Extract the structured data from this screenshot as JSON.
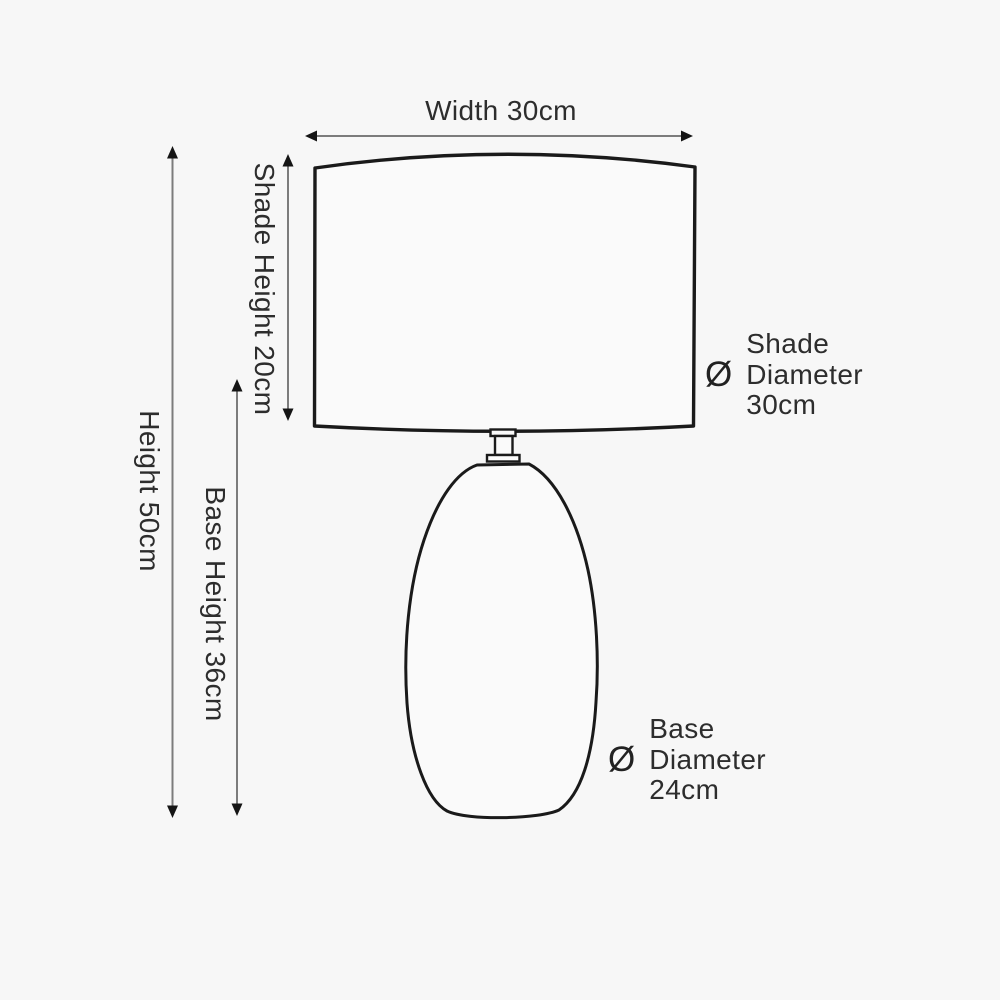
{
  "diagram": {
    "subject": "table-lamp-dimension-diagram",
    "labels": {
      "width": "Width 30cm",
      "overall_height": "Height 50cm",
      "base_height": "Base Height 36cm",
      "shade_height": "Shade Height 20cm"
    },
    "diameter_labels": {
      "shade": {
        "symbol": "Ø",
        "lines": [
          "Shade",
          "Diameter",
          "30cm"
        ]
      },
      "base": {
        "symbol": "Ø",
        "lines": [
          "Base",
          "Diameter",
          "24cm"
        ]
      }
    },
    "colors": {
      "background": "#f7f7f7",
      "outline": "#1a1a1a",
      "arrow_line": "#7c7c7c",
      "arrow_head": "#151515",
      "text": "#2d2d2d"
    }
  }
}
